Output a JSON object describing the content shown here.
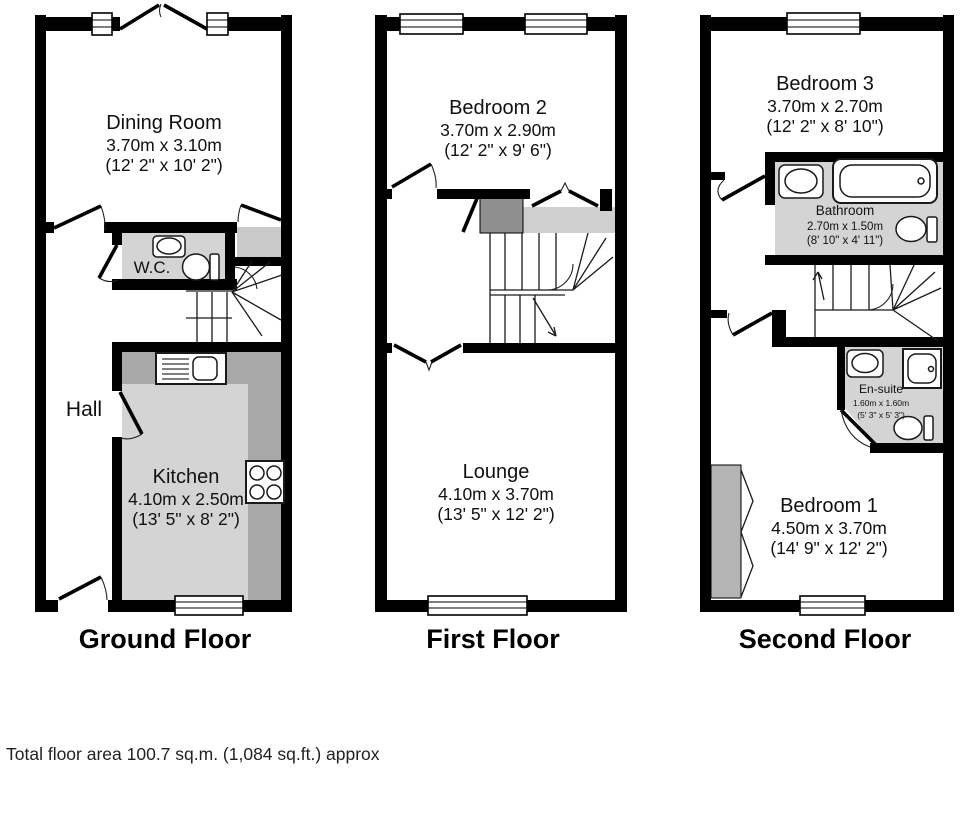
{
  "floors": {
    "ground": {
      "title": "Ground Floor",
      "rooms": {
        "dining_room": {
          "name": "Dining Room",
          "metric": "3.70m x 3.10m",
          "imperial": "(12' 2\" x 10' 2\")"
        },
        "wc": {
          "name": "W.C."
        },
        "hall": {
          "name": "Hall"
        },
        "kitchen": {
          "name": "Kitchen",
          "metric": "4.10m x 2.50m",
          "imperial": "(13' 5\" x 8' 2\")"
        }
      }
    },
    "first": {
      "title": "First Floor",
      "rooms": {
        "bedroom2": {
          "name": "Bedroom 2",
          "metric": "3.70m x 2.90m",
          "imperial": "(12' 2\" x 9' 6\")"
        },
        "lounge": {
          "name": "Lounge",
          "metric": "4.10m x 3.70m",
          "imperial": "(13' 5\" x 12' 2\")"
        }
      }
    },
    "second": {
      "title": "Second Floor",
      "rooms": {
        "bedroom3": {
          "name": "Bedroom 3",
          "metric": "3.70m x 2.70m",
          "imperial": "(12' 2\" x 8' 10\")"
        },
        "bathroom": {
          "name": "Bathroom",
          "metric": "2.70m x 1.50m",
          "imperial": "(8' 10\" x 4' 11\")"
        },
        "ensuite": {
          "name": "En-suite",
          "metric": "1.60m x 1.60m",
          "imperial": "(5' 3\" x 5' 3\")"
        },
        "bedroom1": {
          "name": "Bedroom 1",
          "metric": "4.50m x 3.70m",
          "imperial": "(14' 9\" x 12' 2\")"
        }
      }
    }
  },
  "footer": {
    "total_area": "Total floor area 100.7 sq.m. (1,084 sq.ft.) approx"
  },
  "palette": {
    "wall": "#000000",
    "floor_gray": "#d4d4d4",
    "counter_gray": "#a8a8a8",
    "cupboard_dark": "#8f8f8f",
    "landing_gray": "#cfcfcf",
    "wardrobe_gray": "#b4b4b4",
    "background": "#ffffff"
  }
}
